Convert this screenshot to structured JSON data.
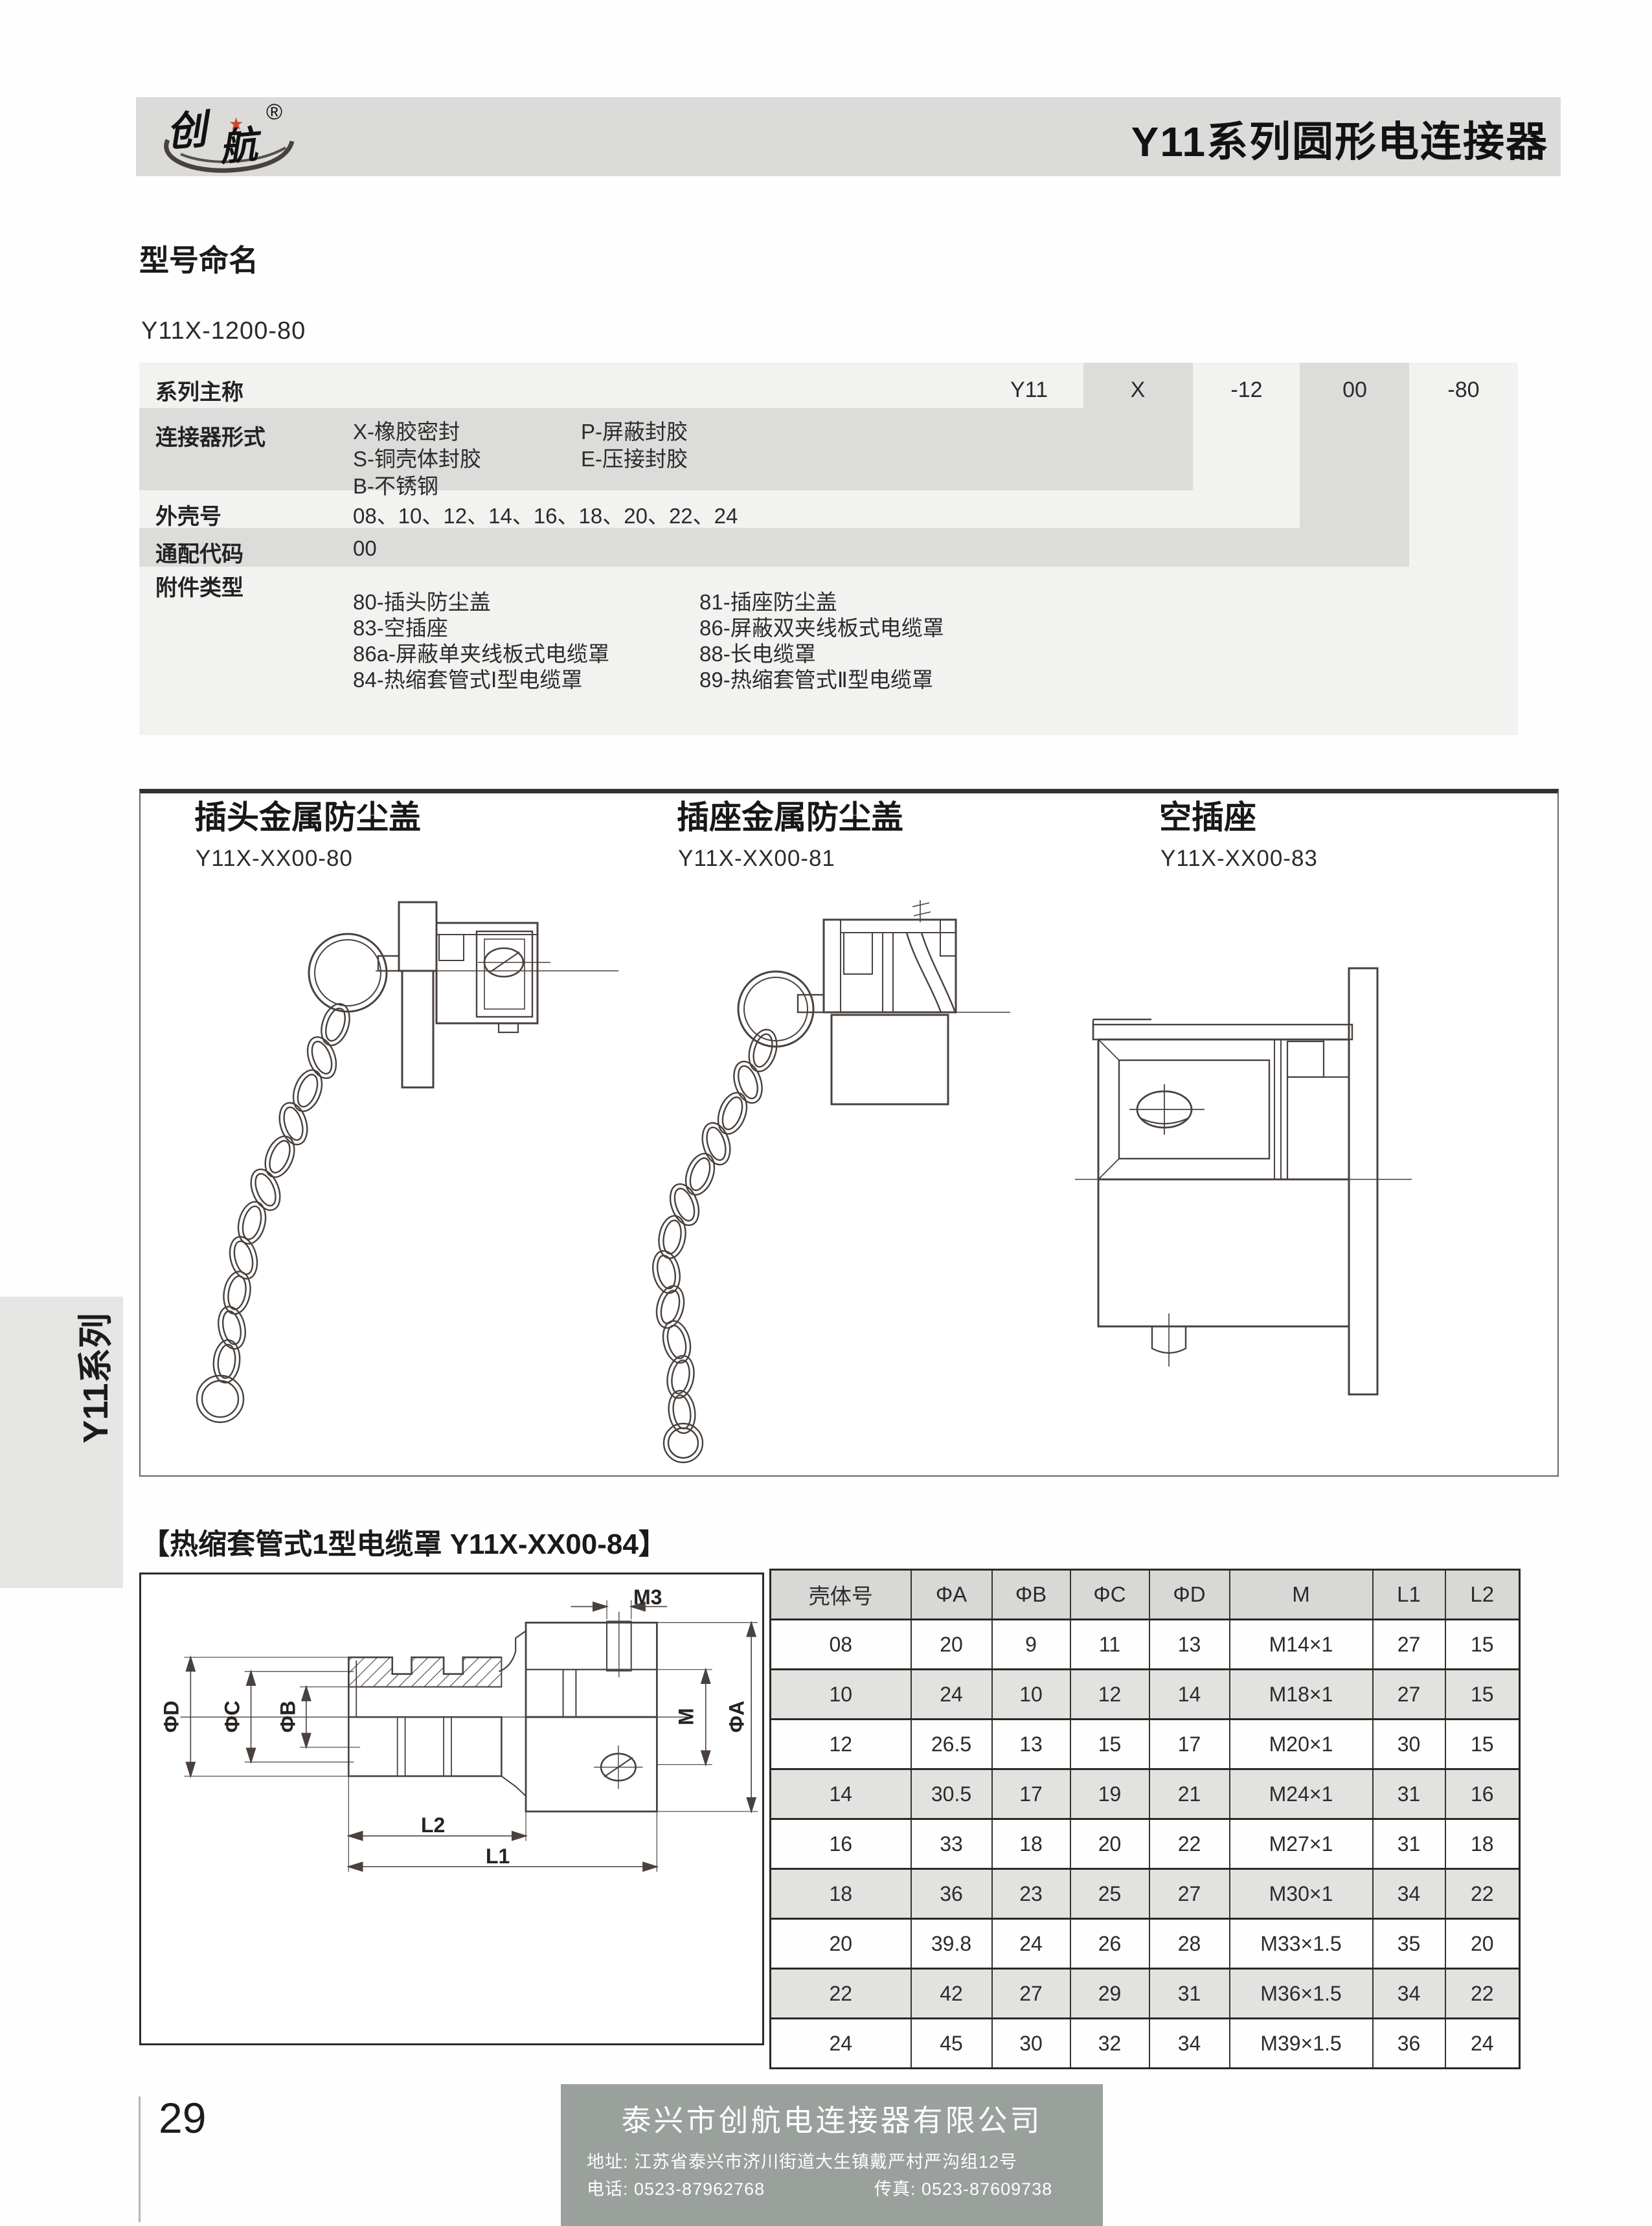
{
  "header": {
    "logo_text": "创航",
    "registered_mark": "®",
    "title": "Y11系列圆形电连接器"
  },
  "naming": {
    "heading": "型号命名",
    "example": "Y11X-1200-80",
    "codes": [
      "Y11",
      "X",
      "-12",
      "00",
      "-80"
    ],
    "rows": [
      {
        "label": "系列主称"
      },
      {
        "label": "连接器形式",
        "col1": [
          "X-橡胶密封",
          "S-铜壳体封胶",
          "B-不锈钢"
        ],
        "col2": [
          "P-屏蔽封胶",
          "E-压接封胶"
        ]
      },
      {
        "label": "外壳号",
        "text": "08、10、12、14、16、18、20、22、24"
      },
      {
        "label": "通配代码",
        "text": "00"
      },
      {
        "label": "附件类型",
        "col1": [
          "80-插头防尘盖",
          "83-空插座",
          "86a-屏蔽单夹线板式电缆罩",
          "84-热缩套管式Ⅰ型电缆罩"
        ],
        "col2": [
          "81-插座防尘盖",
          "86-屏蔽双夹线板式电缆罩",
          "88-长电缆罩",
          "89-热缩套管式Ⅱ型电缆罩"
        ]
      }
    ]
  },
  "drawings": {
    "items": [
      {
        "title": "插头金属防尘盖",
        "model": "Y11X-XX00-80"
      },
      {
        "title": "插座金属防尘盖",
        "model": "Y11X-XX00-81"
      },
      {
        "title": "空插座",
        "model": "Y11X-XX00-83"
      }
    ]
  },
  "heat": {
    "heading": "【热缩套管式1型电缆罩 Y11X-XX00-84】",
    "dims": {
      "m3": "M3",
      "phi_d": "ΦD",
      "phi_c": "ΦC",
      "phi_b": "ΦB",
      "m": "M",
      "phi_a": "ΦA",
      "l2": "L2",
      "l1": "L1"
    },
    "table": {
      "headers": [
        "壳体号",
        "ΦA",
        "ΦB",
        "ΦC",
        "ΦD",
        "M",
        "L1",
        "L2"
      ],
      "rows": [
        [
          "08",
          "20",
          "9",
          "11",
          "13",
          "M14×1",
          "27",
          "15"
        ],
        [
          "10",
          "24",
          "10",
          "12",
          "14",
          "M18×1",
          "27",
          "15"
        ],
        [
          "12",
          "26.5",
          "13",
          "15",
          "17",
          "M20×1",
          "30",
          "15"
        ],
        [
          "14",
          "30.5",
          "17",
          "19",
          "21",
          "M24×1",
          "31",
          "16"
        ],
        [
          "16",
          "33",
          "18",
          "20",
          "22",
          "M27×1",
          "31",
          "18"
        ],
        [
          "18",
          "36",
          "23",
          "25",
          "27",
          "M30×1",
          "34",
          "22"
        ],
        [
          "20",
          "39.8",
          "24",
          "26",
          "28",
          "M33×1.5",
          "35",
          "20"
        ],
        [
          "22",
          "42",
          "27",
          "29",
          "31",
          "M36×1.5",
          "34",
          "22"
        ],
        [
          "24",
          "45",
          "30",
          "32",
          "34",
          "M39×1.5",
          "36",
          "24"
        ]
      ]
    }
  },
  "sidebar": {
    "tab": "Y11系列"
  },
  "footer": {
    "page_number": "29",
    "company": "泰兴市创航电连接器有限公司",
    "address": "地址: 江苏省泰兴市济川街道大生镇戴严村严沟组12号",
    "phone": "电话: 0523-87962768",
    "fax": "传真: 0523-87609738"
  },
  "colors": {
    "accent_blue": "#5b8fc3",
    "star_red": "#d0452f",
    "footer_gray": "#9aa09c"
  }
}
